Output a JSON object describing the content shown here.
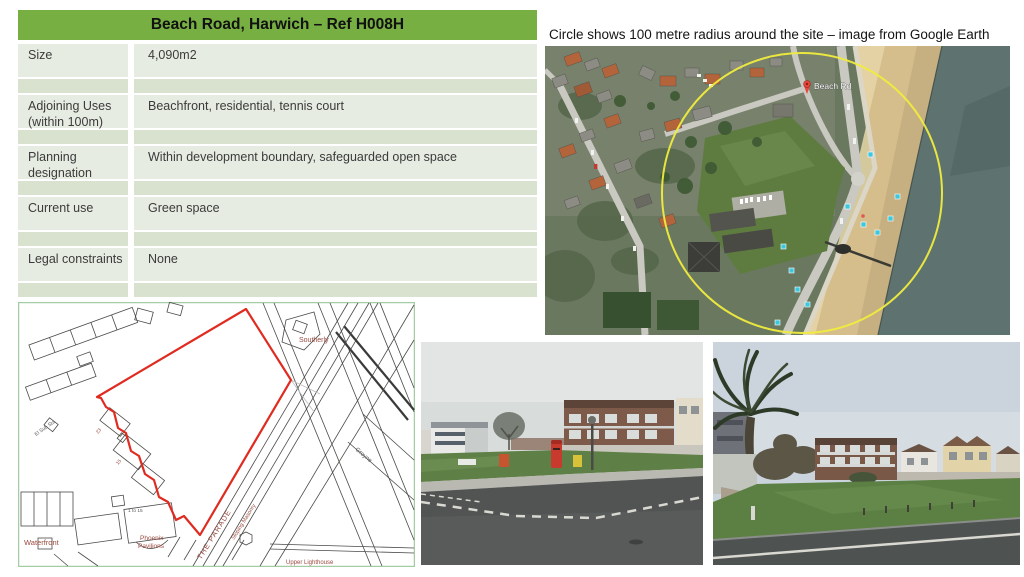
{
  "table": {
    "title": "Beach Road, Harwich – Ref H008H",
    "rows": [
      {
        "label": "Size",
        "value": "4,090m2"
      },
      {
        "label": "Adjoining Uses (within 100m)",
        "value": "Beachfront, residential, tennis court"
      },
      {
        "label": "Planning designation",
        "value": "Within development boundary, safeguarded open space"
      },
      {
        "label": "Current use",
        "value": "Green space"
      },
      {
        "label": "Legal constraints",
        "value": "None"
      }
    ]
  },
  "aerial": {
    "caption": "Circle shows 100 metre radius around the site – image from Google Earth",
    "pin_label": "Beach Rd"
  },
  "site_plan": {
    "labels": {
      "southerly": "Southerly",
      "waterfront": "Waterfront",
      "phoenix_line1": "Phoenix",
      "phoenix_line2": "Pavilions",
      "upper_lighthouse": "Upper Lighthouse",
      "the_parade": "THE PARADE",
      "sloping_masonry": "Sloping Masonry",
      "el_sub_sta": "El Sub Sta",
      "groyne": "Groyne",
      "num_23": "23",
      "num_15": "15",
      "num_1to15": "1 to 15"
    }
  },
  "colors": {
    "table_header_green": "#77AF43",
    "table_row_light": "#E7ECE2",
    "table_row_dark": "#D8E2CF",
    "site_boundary_red": "#E02B20",
    "radius_circle_yellow": "#F0EC3E",
    "plan_border_green": "#A5CDA5",
    "plan_label_maroon": "#9B4A3F"
  }
}
